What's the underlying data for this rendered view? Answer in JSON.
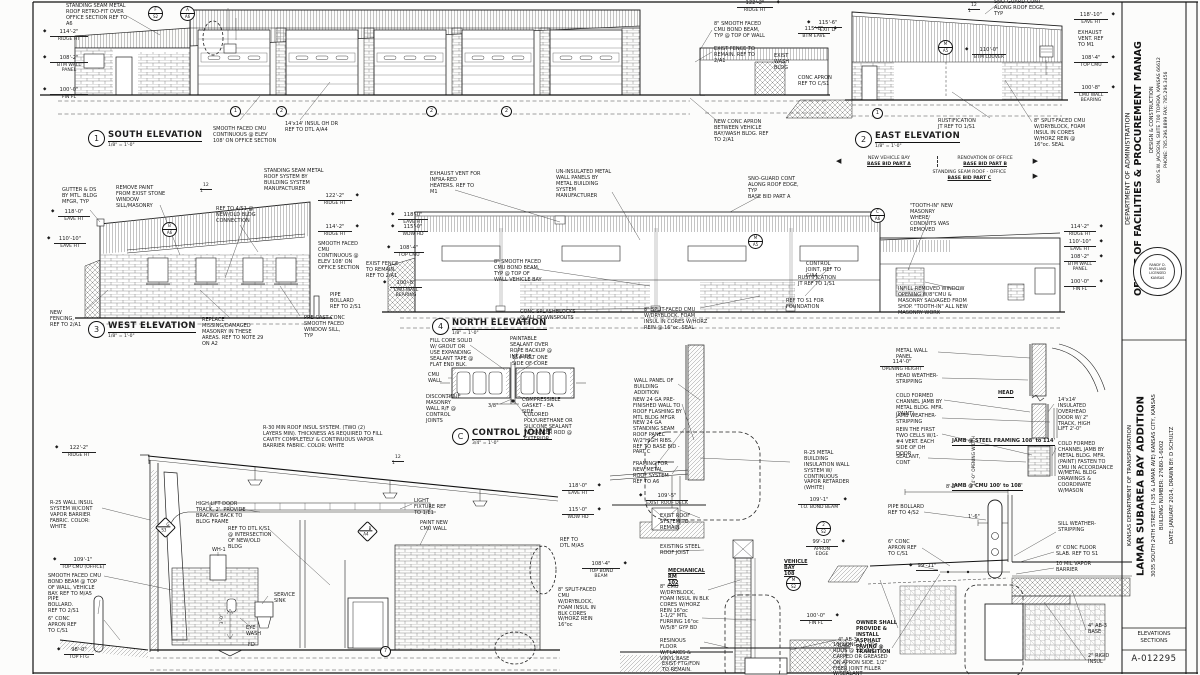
{
  "slope": {
    "r": "12",
    "n": "1"
  },
  "titleblock": {
    "dept": "DEPARTMENT OF ADMINISTRATION",
    "office": "OFFICE OF FACILITIES & PROCUREMENT MANAG",
    "division": "DESIGN & CONSTRUCTION",
    "address": "800 S.W. JACKSON, SUITE 700   TOPEKA, KANSAS 66612",
    "phone": "PHONE: 785.296.8899    FAX: 785.296.3456",
    "kdot": "KANSAS DEPARTMENT OF TRANSPORTATION",
    "project": "LAMAR SUBAREA BAY ADDITION",
    "location": "3035 SOUTH 24TH STREET (I-35 & LAMAR AVE)  KANSAS CITY, KANSAS",
    "building_number": "BUILDING NUMBER: 27680-1-6002",
    "date_drawn": "DATE: JANUARY 2014, DRAWN BY: D SCHULTZ",
    "sheet_label": "ELEVATIONS\nSECTIONS",
    "sheet_number": "A-012295",
    "seal_name": "RANDY D. RIVELAND",
    "seal_mid": "LICENSED",
    "seal_bottom": "KANSAS"
  },
  "views": {
    "south": {
      "num": "1",
      "title": "SOUTH ELEVATION",
      "scale": "1/8\" = 1'-0\"",
      "marks": [
        {
          "d": "114'-2\"",
          "l": "RIDGE HT"
        },
        {
          "d": "108'-2\"",
          "l": "BTM WALL\nPANEL"
        },
        {
          "d": "100'-0\"",
          "l": "FIN FL"
        },
        {
          "d": "122'-2\"",
          "l": "RIDGE HT"
        },
        {
          "d": "115'-8\"",
          "l": "BTM EAVE"
        }
      ],
      "notes": [
        "STANDING SEAM METAL ROOF RETRO-FIT OVER OFFICE SECTION REF TO A6",
        "SMOOTH FACED CMU CONTINUOUS @ ELEV 108' ON OFFICE SECTION",
        "14'x14' INSUL OH DR REF TO DTL A/A4",
        "8\" SMOOTH FACED CMU BOND BEAM, TYP @ TOP OF WALL",
        "EXIST FENCE TO REMAIN. REF TO 2/A1",
        "EXIST WASH BLDG",
        "CONC APRON REF TO C/S1",
        "NEW CONC APRON BETWEEN VEHICLE BAY/WASH BLDG. REF TO 2/A1"
      ],
      "bubbles": [
        [
          "F",
          "S2"
        ],
        [
          "A",
          "A6"
        ]
      ],
      "grid": [
        "1",
        "2",
        "2",
        "2"
      ]
    },
    "east": {
      "num": "2",
      "title": "EAST ELEVATION",
      "scale": "1/8\" = 1'-0\"",
      "marks": [
        {
          "d": "118'-10\"",
          "l": "EAVE HT"
        },
        {
          "d": "108'-4\"",
          "l": "TOP CMU"
        },
        {
          "d": "100'-8\"",
          "l": "CMU WALL\nBEARING"
        },
        {
          "d": "110'-0\"",
          "l": "BTM LOUVER"
        },
        {
          "d": "115'-6\"",
          "l": "EXIT LT"
        }
      ],
      "notes": [
        "SNO-GUARD CONT ALONG ROOF EDGE, TYP",
        "EXHAUST VENT. REF TO M1",
        "RUSTIFICATION JT REF TO 1/S1",
        "8\" SPLIT-FACED CMU W/DRYBLOCK, FOAM INSUL IN CORES W/HORZ REIN @ 16\"oc. SEAL"
      ],
      "bubbles": [
        [
          "M",
          "A5"
        ]
      ],
      "grid": "1"
    },
    "west": {
      "num": "3",
      "title": "WEST ELEVATION",
      "scale": "1/8\" = 1'-0\"",
      "marks": [
        {
          "d": "118'-0\"",
          "l": "EAVE HT"
        },
        {
          "d": "110'-10\"",
          "l": "EAVE HT"
        },
        {
          "d": "122'-2\"",
          "l": "RIDGE HT"
        },
        {
          "d": "114'-2\"",
          "l": "RIDGE HT"
        }
      ],
      "notes": [
        "GUTTER & DS BY MTL. BLDG MFGR, TYP",
        "REMOVE PAINT FROM EXIST STONE WINDOW SILL/MASONRY",
        "STANDING SEAM METAL ROOF SYSTEM BY BUILDING SYSTEM MANUFACTURER",
        "REF TO 4/S1 @ NEW/OLD BLDG CONNECTION",
        "SMOOTH FACED CMU CONTINUOUS @ ELEV 108' ON OFFICE SECTION",
        "NEW FENCING, REF TO 2/A1",
        "REPLACE MISSING/DAMAGED MASONRY IN THESE AREAS. REF TO NOTE 29 ON A2",
        "PRE-CAST CONC SMOOTH FACED WINDOW SILL, TYP",
        "PIPE BOLLARD REF TO 2/S1"
      ],
      "bubbles": [
        [
          "B",
          "A6"
        ]
      ]
    },
    "north": {
      "num": "4",
      "title": "NORTH ELEVATION",
      "scale": "1/8\" = 1'-0\"",
      "marks": [
        {
          "d": "118'-0\"",
          "l": "EAVE HT"
        },
        {
          "d": "115'-0\"",
          "l": "WDW HD"
        },
        {
          "d": "108'-4\"",
          "l": "TOP CMU"
        },
        {
          "d": "100'-8\"",
          "l": "CMU WALL\nBEARING"
        },
        {
          "d": "114'-2\"",
          "l": "RIDGE HT"
        },
        {
          "d": "110'-10\"",
          "l": "EAVE HT"
        },
        {
          "d": "108'-2\"",
          "l": "BTM WALL\nPANEL"
        },
        {
          "d": "100'-0\"",
          "l": "FIN FL"
        }
      ],
      "notes": [
        "EXHAUST VENT FOR INFRA-RED HEATERS. REF TO M1",
        "UN-INSULATED METAL WALL PANELS BY METAL BUILDING SYSTEM MANUFACTURER",
        "SNO-GUARD CONT ALONG ROOF EDGE, TYP\nBASE BID PART A",
        "EXIST FENCE TO REMAIN. REF TO 2/A1",
        "8\" SMOOTH FACED CMU BOND BEAM, TYP @ TOP OF WALL VEHICLE BAY",
        "CONC SPLASHBLOCKS @ ALL DOWNSPOUTS TYP",
        "8\" SPLIT-FACED CMU W/DRYBLOCK, FOAM INSUL IN CORES W/HORZ REIN @ 16\"oc. SEAL",
        "CONTROL JOINT, REF TO C/A4",
        "RUSTIFICATION JT REF TO 1/S1",
        "REF TO S1 FOR FOUNDATION",
        "\"TOOTH-IN\" NEW MASONRY WHERE CONDUITS WAS REMOVED",
        "INFILL REMOVED WINDOW OPENING W/8\"CMU & MASONRY SALVAGED FROM SHOP. \"TOOTH-IN\" ALL NEW MASONRY WORK"
      ],
      "bubbles": [
        [
          "C",
          "A6"
        ],
        [
          "M",
          "A5"
        ]
      ]
    },
    "basebid": {
      "a1": "NEW VEHICLE BAY",
      "a2": "BASE BID PART A",
      "b1": "RENOVATION OF OFFICE",
      "b2": "BASE BID PART B",
      "c1": "STANDING SEAM ROOF - OFFICE",
      "c2": "BASE BID PART C"
    },
    "cj": {
      "num": "C",
      "title": "CONTROL JOINT",
      "scale": "3/4\" = 1'-0\"",
      "notes": [
        "FILL CORE SOLID W/ GROUT OR USE EXPANDING SEALANT TAPE @ FLAT END BLK.",
        "PAINTABLE SEALANT OVER ROPE BACKUP @ INT SIDE",
        "15# FELT ONE SIDE OF CORE",
        "CMU WALL",
        "DISCONTINUE MASONRY WALL R/F @ CONTROL JOINTS",
        "3/8\"",
        "COMPRESSIBLE GASKET - EA SIDE",
        "COLORED POLYURETHANE OR SILICONE SEALANT W/ BACKER ROD @ EXTERIOR"
      ]
    },
    "section": {
      "marks": [
        {
          "d": "122'-2\"",
          "l": "RIDGE HT"
        },
        {
          "d": "109'-1\"",
          "l": "TOP CMU (OFFICE)"
        },
        {
          "d": "98'-0\"",
          "l": "TOP FTG"
        },
        {
          "d": "118'-0\"",
          "l": "EAVE HT"
        },
        {
          "d": "115'-0\"",
          "l": "WDW HD"
        },
        {
          "d": "108'-4\"",
          "l": "TOP BOND BEAM"
        }
      ],
      "notes": [
        "R-30 MIN ROOF INSUL SYSTEM. (TWO (2) LAYERS MIN). THICKNESS AS REQUIRED TO FILL CAVITY COMPLETELY & CONTINUOUS VAPOR BARRIER FABRIC. COLOR: WHITE",
        "R-25 WALL INSUL SYSTEM W/CONT VAPOR BARRIER FABRIC. COLOR: WHITE",
        "HIGH LIFT DOOR TRACK, 2'. PROVIDE BRACING BACK TO BLDG FRAME",
        "LIGHT FIXTURE REF TO 1/E1",
        "REF TO DTL K/S1 @ INTERSECTION OF NEW/OLD BLDG",
        "PAINT NEW CMU WALL",
        "SMOOTH FACED CMU BOND BEAM @ TOP OF WALL, VEHICLE BAY. REF TO M/A5",
        "PIPE BOLLARD. REF TO 2/S1",
        "6\" CONC APRON REF TO C/S1",
        "SERVICE SINK",
        "EYE WASH",
        "WH-1",
        "FD",
        "3'-0\"",
        "REF TO DTL M/A5",
        "8\" SPLIT-FACED CMU W/DRYBLOCK, FOAM INSUL IN BLK CORES W/HORZ REIN 16\"oc"
      ],
      "bubbles": [
        [
          "G",
          "S3"
        ],
        [
          "B",
          "A4"
        ]
      ],
      "grid": "7"
    },
    "wallsec": {
      "marks": [
        {
          "d": "109'-5\"",
          "l": "EXIST ROOF DECK"
        },
        {
          "d": "109'-1\"",
          "l": "T.O. BOND BEAM"
        },
        {
          "d": "99'-10\"",
          "l": "APRON\nEDGE"
        },
        {
          "d": "100'-0\"",
          "l": "FIN FL"
        }
      ],
      "notes": [
        "WALL PANEL OF BUILDING ADDITION",
        "NEW 24 GA PRE-FINISHED WALL TO ROOF FLASHING BY MTL BLDG MFGR",
        "NEW 24 GA STANDING SEAM ROOF PANEL W/2\"HIGH RIBS. REF TO BASE BID - PART C",
        "FRAMING FOR NEW METAL ROOF SYSTEM REF TO A6",
        "R-25 METAL BUILDING INSULATION WALL SYSTEM W/ CONTINUOUS VAPOR RETARDER (WHITE)",
        "EXIST ROOF SYSTEM TO REMAIN",
        "EXISTING STEEL ROOF JOIST",
        "MECHANICAL RM\n102",
        "VEHICLE BAY\n108",
        "8\" CMU W/DRYBLOCK, FOAM INSUL IN BLK CORES W/HORZ REIN 16\"oc",
        "1-1/2\" MTL FURRING 16\"oc W/5/8\" GYP BD",
        "RESINOUS FLOOR W/FLAKES & VINYL BASE",
        "EXIST FTG/FDN TO REMAIN.",
        "4\" AB-3 BASE"
      ],
      "bubbles": [
        [
          "2",
          "S2"
        ],
        [
          "M",
          "S2"
        ]
      ]
    },
    "jamb": {
      "marks": [
        {
          "d": "114'-0\"",
          "l": "OPENING HEIGHT"
        }
      ],
      "notes": [
        "METAL WALL PANEL",
        "HEAD WEATHER-STRIPPING",
        "COLD FORMED CHANNEL JAMB BY METAL BLDG. MFR. (PAINT)",
        "JAMB WEATHER-STRIPPING",
        "REIN THE FIRST TWO CELLS W/1-#4 VERT. EACH SIDE OF OH DOOR",
        "SEALANT, CONT",
        "14'x14' INSULATED OVERHEAD DOOR W/ 2\" TRACK, HIGH LIFT 2'-0\"",
        "COLD FORMED CHANNEL JAMB BY METAL BLDG. MFR. (PAINT) FASTEN TO CMU IN ACCORDANCE W/METAL BLDG DRAWINGS & COORDINATE W/MASON"
      ],
      "labels": [
        "HEAD",
        "JAMB @ STEEL FRAMING 108' to 114'",
        "JAMB @ CMU 100' to 108'"
      ],
      "dims": [
        "14'-0\" OPENING WIDTH",
        "8'-0\"",
        "1'-6\"",
        "99'-11\""
      ]
    },
    "apron": {
      "notes": [
        "PIPE BOLLARD REF TO 4/S2",
        "6\" CONC APRON REF TO C/S1",
        "SILL WEATHER-STRIPPING",
        "6\" CONC FLOOR SLAB. REF TO S1",
        "10 MIL VAPOR BARRIER",
        "OWNER SHALL PROVIDE & INSTALL ASPHALT PAVING @ TRANSITION",
        "16\" LONG X 1/2\"ø RODS @ 12\" O.C. CAPPED OR GREASED ON APRON SIDE. 1/2\" FIBER JOINT FILLER W/SEALANT",
        "4\" AB-3 BASE",
        "2\" RIGID INSUL"
      ]
    }
  }
}
